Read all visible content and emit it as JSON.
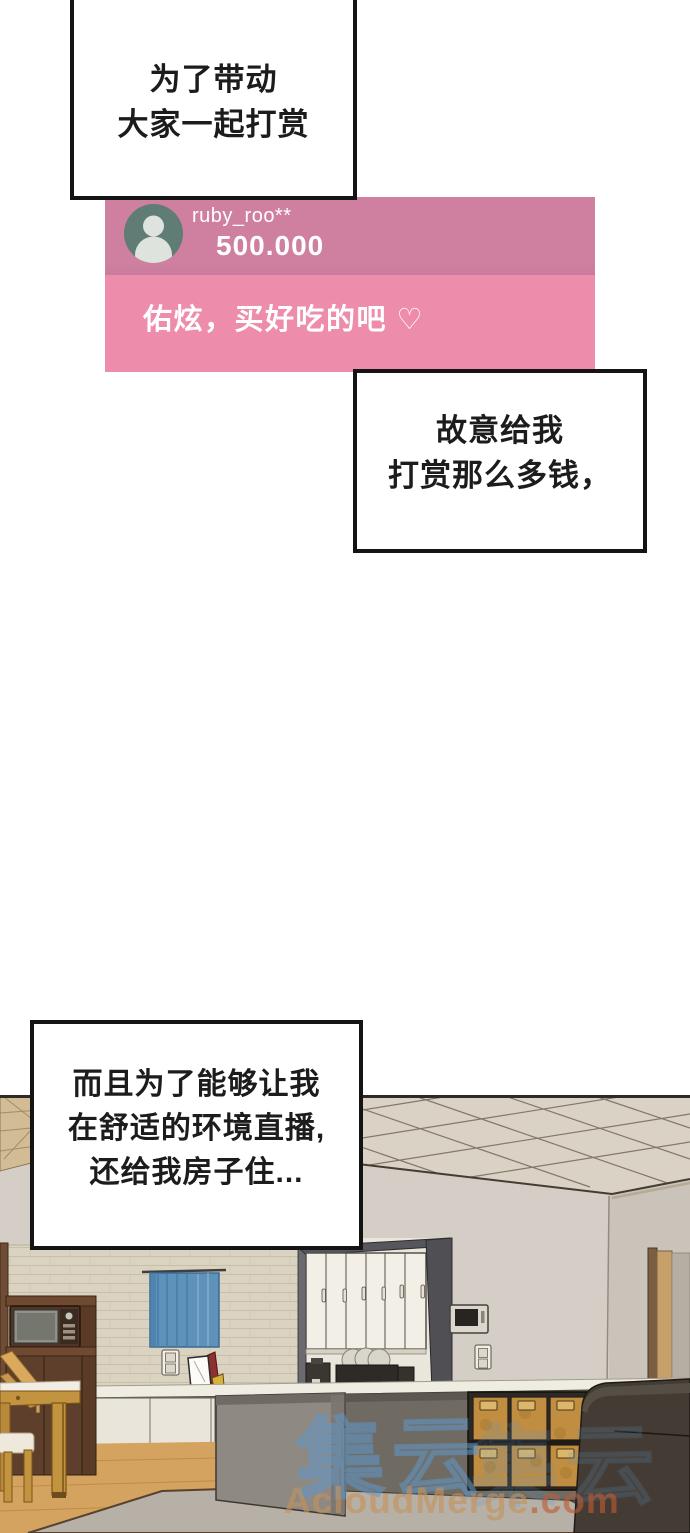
{
  "speech_bubbles": [
    {
      "id": "bubble-1",
      "lines": [
        "为了带动",
        "大家一起打赏"
      ]
    },
    {
      "id": "bubble-2",
      "lines": [
        "故意给我",
        "打赏那么多钱，"
      ]
    },
    {
      "id": "bubble-3",
      "lines": [
        "而且为了能够让我",
        "在舒适的环境直播,",
        "还给我房子住..."
      ]
    }
  ],
  "donation_card": {
    "username": "ruby_roo**",
    "amount": "500.000",
    "message": "佑炫，买好吃的吧 ♡"
  },
  "watermarks": {
    "glyphs": "集云",
    "site_name": "AcloudMerge",
    "site_tld": ".com"
  },
  "theme": {
    "bubble_border": "#141414",
    "bubble_text": "#1c1c1c",
    "card_header": "#cf80a0",
    "card_body": "#ee8cab",
    "avatar_bg": "#5f7d74",
    "avatar_person": "#dee3de",
    "card_text": "#ffffff",
    "watermark_blue": "#5f97c9",
    "watermark_tan": "#c6925b",
    "watermark_red": "#bf5a33"
  },
  "scene_palette": {
    "wall": "#d4cec6",
    "ceiling": "#d9d2c5",
    "floor": "#d3a35f",
    "curtain": "#5e92bb",
    "rug": "#b6b0a6",
    "sofa": "#443c34",
    "boxes": "#c08d41",
    "island": "#8e8983"
  }
}
